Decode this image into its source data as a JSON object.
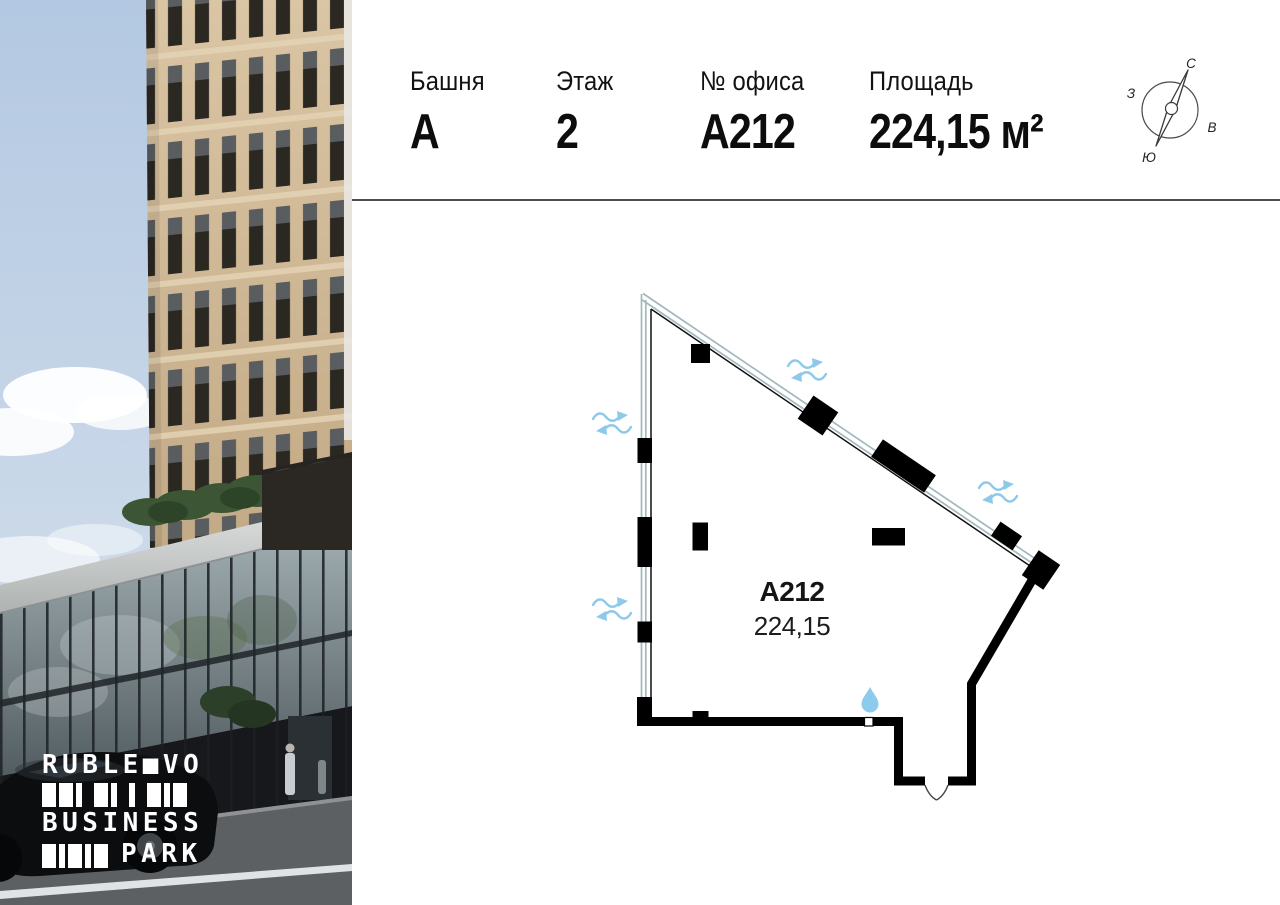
{
  "header": {
    "fields": [
      {
        "label": "Башня",
        "value": "А"
      },
      {
        "label": "Этаж",
        "value": "2"
      },
      {
        "label": "№ офиса",
        "value": "А212"
      },
      {
        "label": "Площадь",
        "value": "224,15 м²"
      }
    ]
  },
  "compass": {
    "north": "С",
    "south": "Ю",
    "west": "З",
    "east": "В"
  },
  "plan": {
    "unit_label": "А212",
    "area_label": "224,15",
    "legend": {
      "walls_color": "#000000",
      "glazing_color": "#a3b8be",
      "airflow_color": "#8ec9ea",
      "water_point_color": "#8ccbec"
    }
  },
  "logo": {
    "line1": "RUBLE■VO",
    "line2": "BUSINESS",
    "line3": "PARK",
    "bar_rows": [
      [
        "w",
        "w",
        "n",
        "g",
        "w",
        "n",
        "g",
        "n",
        "g",
        "w",
        "n",
        "w"
      ],
      [
        "w",
        "n",
        "w",
        "n",
        "w"
      ]
    ]
  }
}
